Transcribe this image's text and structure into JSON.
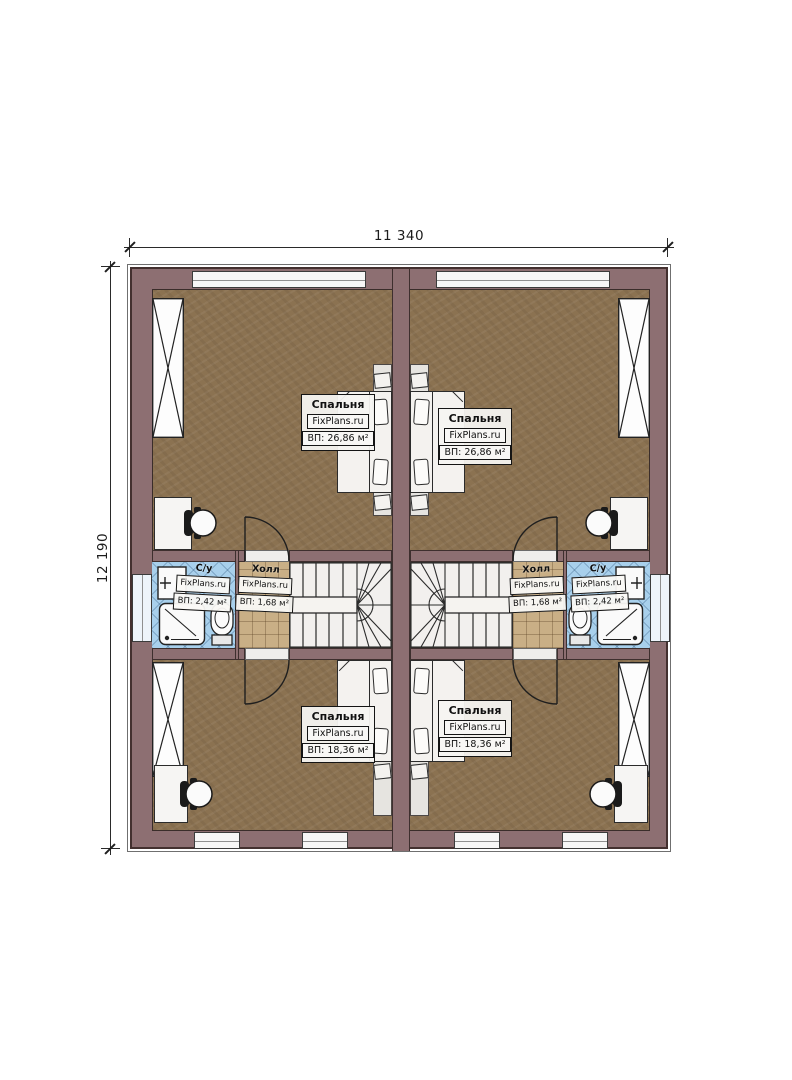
{
  "dims": {
    "width_label": "11 340",
    "height_label": "12 190"
  },
  "rooms": {
    "bedroom_top_left": {
      "name": "Спальня",
      "brand": "FixPlans.ru",
      "area": "ВП: 26,86 м²"
    },
    "bedroom_top_right": {
      "name": "Спальня",
      "brand": "FixPlans.ru",
      "area": "ВП: 26,86 м²"
    },
    "bedroom_bottom_left": {
      "name": "Спальня",
      "brand": "FixPlans.ru",
      "area": "ВП: 18,36 м²"
    },
    "bedroom_bottom_right": {
      "name": "Спальня",
      "brand": "FixPlans.ru",
      "area": "ВП: 18,36 м²"
    },
    "hall_left": {
      "name": "Холл",
      "brand": "FixPlans.ru",
      "area": "ВП: 1,68 м²"
    },
    "hall_right": {
      "name": "Холл",
      "brand": "FixPlans.ru",
      "area": "ВП: 1,68 м²"
    },
    "wc_left": {
      "name": "С/у",
      "brand": "FixPlans.ru",
      "area": "ВП: 2,42 м²"
    },
    "wc_right": {
      "name": "С/у",
      "brand": "FixPlans.ru",
      "area": "ВП: 2,42 м²"
    }
  },
  "colors": {
    "wall": "#8d6f72",
    "floor": "#8b7251",
    "hall_tile": "#c9af86",
    "bath_tile": "#a8d0ec",
    "window_fill": "#f6f6f6",
    "stair_fill": "#f2f0ee"
  }
}
